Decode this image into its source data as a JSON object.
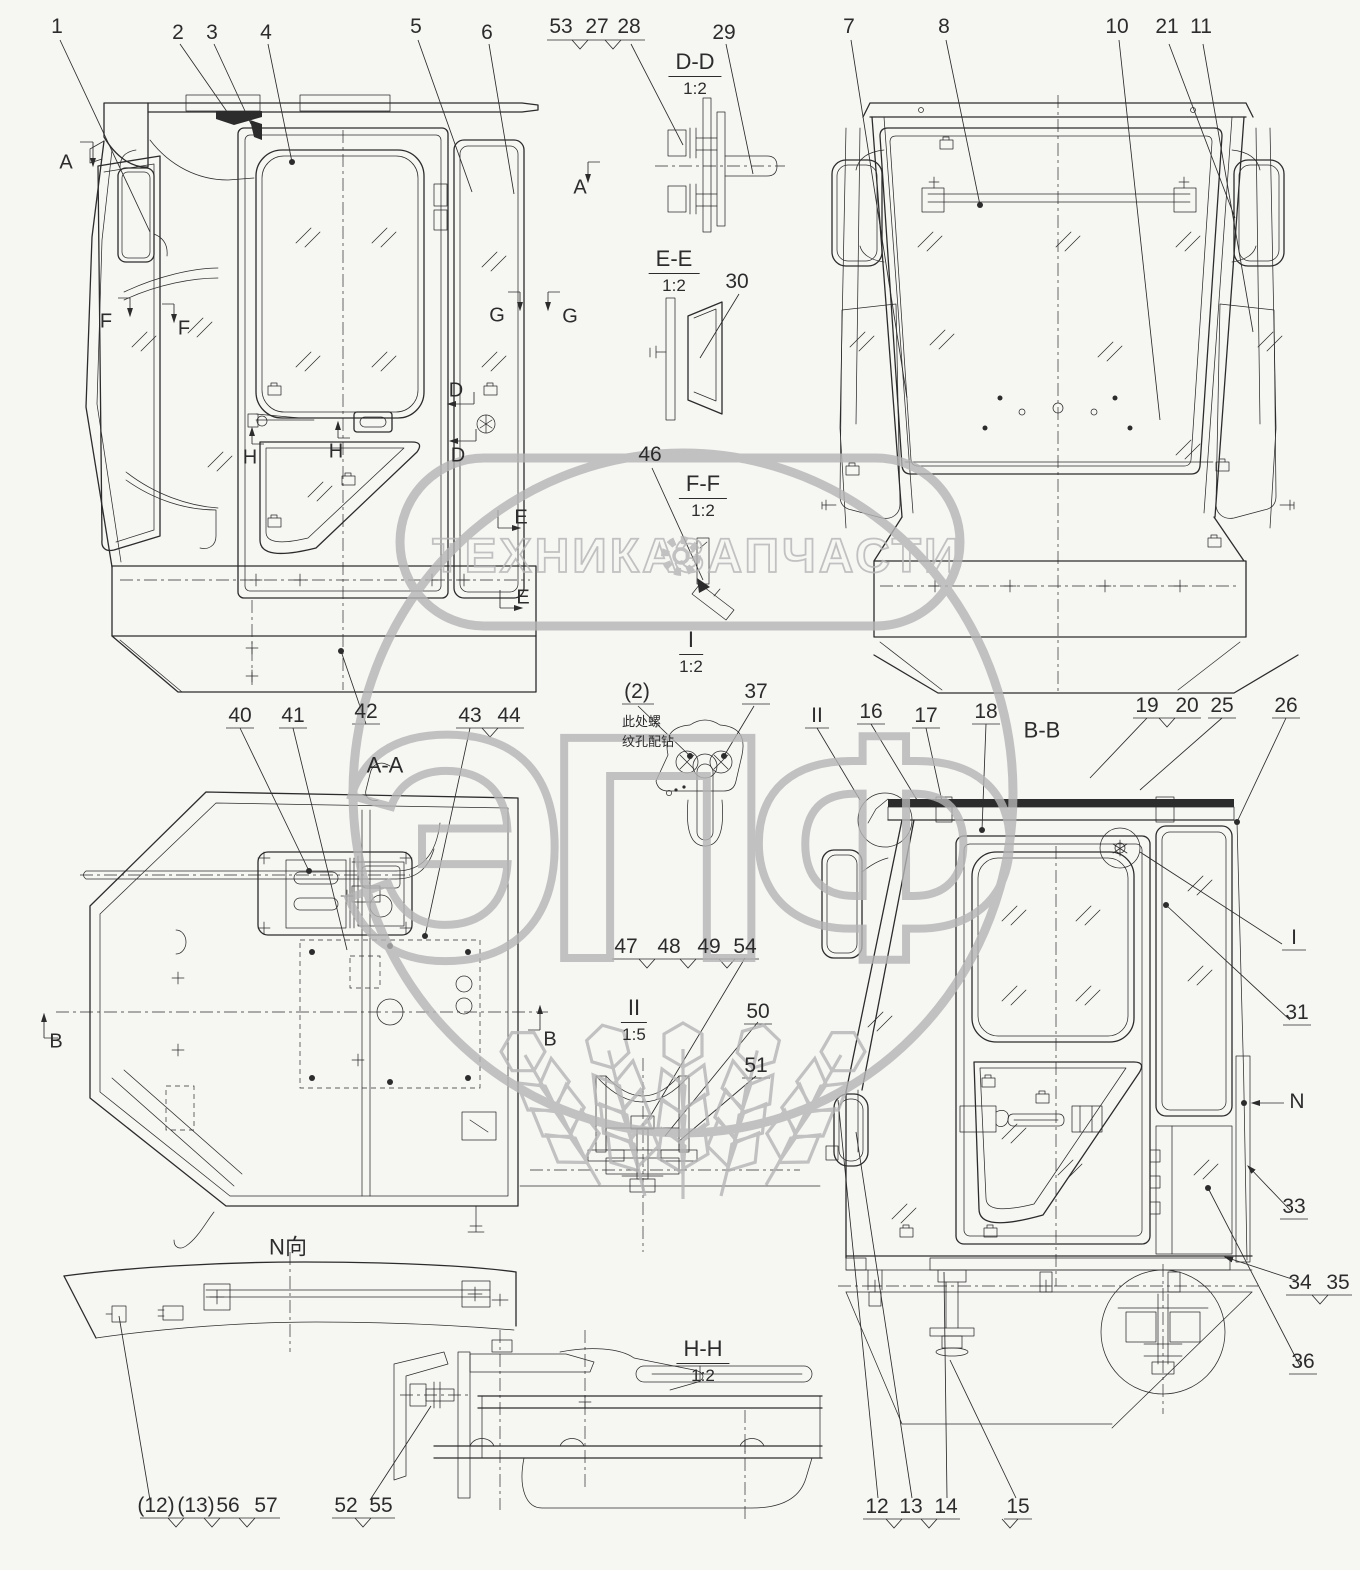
{
  "watermark": {
    "brand_left": "ТЕХНИКА",
    "brand_right": "ЗАПЧАСТИ",
    "logo": "ЭПФ",
    "gear_icon": "gear",
    "color": "#b5b5b5"
  },
  "note": {
    "lines": [
      "此处螺",
      "纹孔配钻"
    ],
    "x": 622,
    "y": 712
  },
  "sections": [
    {
      "label": "D-D",
      "scale": "1:2",
      "x": 695,
      "y": 74
    },
    {
      "label": "E-E",
      "scale": "1:2",
      "x": 674,
      "y": 271
    },
    {
      "label": "F-F",
      "scale": "1:2",
      "x": 703,
      "y": 496
    },
    {
      "label": "I",
      "scale": "1:2",
      "x": 691,
      "y": 652
    },
    {
      "label": "A-A",
      "scale": "",
      "x": 385,
      "y": 766
    },
    {
      "label": "B-B",
      "scale": "",
      "x": 1042,
      "y": 731
    },
    {
      "label": "II",
      "scale": "1:5",
      "x": 634,
      "y": 1020
    },
    {
      "label": "N向",
      "scale": "",
      "x": 288,
      "y": 1246
    },
    {
      "label": "H-H",
      "scale": "1:2",
      "x": 703,
      "y": 1361
    }
  ],
  "callouts": [
    {
      "t": "1",
      "x": 57,
      "y": 27
    },
    {
      "t": "2",
      "x": 178,
      "y": 33
    },
    {
      "t": "3",
      "x": 212,
      "y": 33
    },
    {
      "t": "4",
      "x": 266,
      "y": 33
    },
    {
      "t": "5",
      "x": 416,
      "y": 27
    },
    {
      "t": "6",
      "x": 487,
      "y": 33
    },
    {
      "t": "53",
      "x": 561,
      "y": 27
    },
    {
      "t": "27",
      "x": 597,
      "y": 27
    },
    {
      "t": "28",
      "x": 629,
      "y": 27
    },
    {
      "t": "29",
      "x": 724,
      "y": 33
    },
    {
      "t": "7",
      "x": 849,
      "y": 27
    },
    {
      "t": "8",
      "x": 944,
      "y": 27
    },
    {
      "t": "10",
      "x": 1117,
      "y": 27
    },
    {
      "t": "21",
      "x": 1167,
      "y": 27
    },
    {
      "t": "11",
      "x": 1201,
      "y": 27
    },
    {
      "t": "30",
      "x": 737,
      "y": 282
    },
    {
      "t": "46",
      "x": 650,
      "y": 455
    },
    {
      "t": "(2)",
      "x": 637,
      "y": 692
    },
    {
      "t": "37",
      "x": 756,
      "y": 692
    },
    {
      "t": "40",
      "x": 240,
      "y": 716
    },
    {
      "t": "41",
      "x": 293,
      "y": 716
    },
    {
      "t": "42",
      "x": 366,
      "y": 712
    },
    {
      "t": "43",
      "x": 470,
      "y": 716
    },
    {
      "t": "44",
      "x": 509,
      "y": 716
    },
    {
      "t": "II",
      "x": 817,
      "y": 716
    },
    {
      "t": "16",
      "x": 871,
      "y": 712
    },
    {
      "t": "17",
      "x": 926,
      "y": 716
    },
    {
      "t": "18",
      "x": 986,
      "y": 712
    },
    {
      "t": "19",
      "x": 1147,
      "y": 706
    },
    {
      "t": "20",
      "x": 1187,
      "y": 706
    },
    {
      "t": "25",
      "x": 1222,
      "y": 706
    },
    {
      "t": "26",
      "x": 1286,
      "y": 706
    },
    {
      "t": "I",
      "x": 1294,
      "y": 938
    },
    {
      "t": "31",
      "x": 1297,
      "y": 1013
    },
    {
      "t": "N",
      "x": 1297,
      "y": 1102
    },
    {
      "t": "33",
      "x": 1294,
      "y": 1207
    },
    {
      "t": "34",
      "x": 1300,
      "y": 1283
    },
    {
      "t": "35",
      "x": 1338,
      "y": 1283
    },
    {
      "t": "36",
      "x": 1303,
      "y": 1362
    },
    {
      "t": "47",
      "x": 626,
      "y": 947
    },
    {
      "t": "48",
      "x": 669,
      "y": 947
    },
    {
      "t": "49",
      "x": 709,
      "y": 947
    },
    {
      "t": "54",
      "x": 745,
      "y": 947
    },
    {
      "t": "50",
      "x": 758,
      "y": 1012
    },
    {
      "t": "51",
      "x": 756,
      "y": 1066
    },
    {
      "t": "(12)",
      "x": 156,
      "y": 1506
    },
    {
      "t": "(13)",
      "x": 196,
      "y": 1506
    },
    {
      "t": "56",
      "x": 228,
      "y": 1506
    },
    {
      "t": "57",
      "x": 266,
      "y": 1506
    },
    {
      "t": "52",
      "x": 346,
      "y": 1506
    },
    {
      "t": "55",
      "x": 381,
      "y": 1506
    },
    {
      "t": "12",
      "x": 877,
      "y": 1507
    },
    {
      "t": "13",
      "x": 911,
      "y": 1507
    },
    {
      "t": "14",
      "x": 946,
      "y": 1507
    },
    {
      "t": "15",
      "x": 1018,
      "y": 1507
    }
  ],
  "view_letters": [
    {
      "t": "A",
      "x": 66,
      "y": 163
    },
    {
      "t": "A",
      "x": 580,
      "y": 188
    },
    {
      "t": "F",
      "x": 106,
      "y": 322
    },
    {
      "t": "F",
      "x": 184,
      "y": 329
    },
    {
      "t": "G",
      "x": 497,
      "y": 316
    },
    {
      "t": "G",
      "x": 570,
      "y": 317
    },
    {
      "t": "D",
      "x": 456,
      "y": 391
    },
    {
      "t": "D",
      "x": 458,
      "y": 456
    },
    {
      "t": "H",
      "x": 250,
      "y": 458
    },
    {
      "t": "H",
      "x": 336,
      "y": 452
    },
    {
      "t": "E",
      "x": 521,
      "y": 518
    },
    {
      "t": "E",
      "x": 523,
      "y": 598
    },
    {
      "t": "B",
      "x": 56,
      "y": 1042
    },
    {
      "t": "B",
      "x": 550,
      "y": 1040
    }
  ]
}
